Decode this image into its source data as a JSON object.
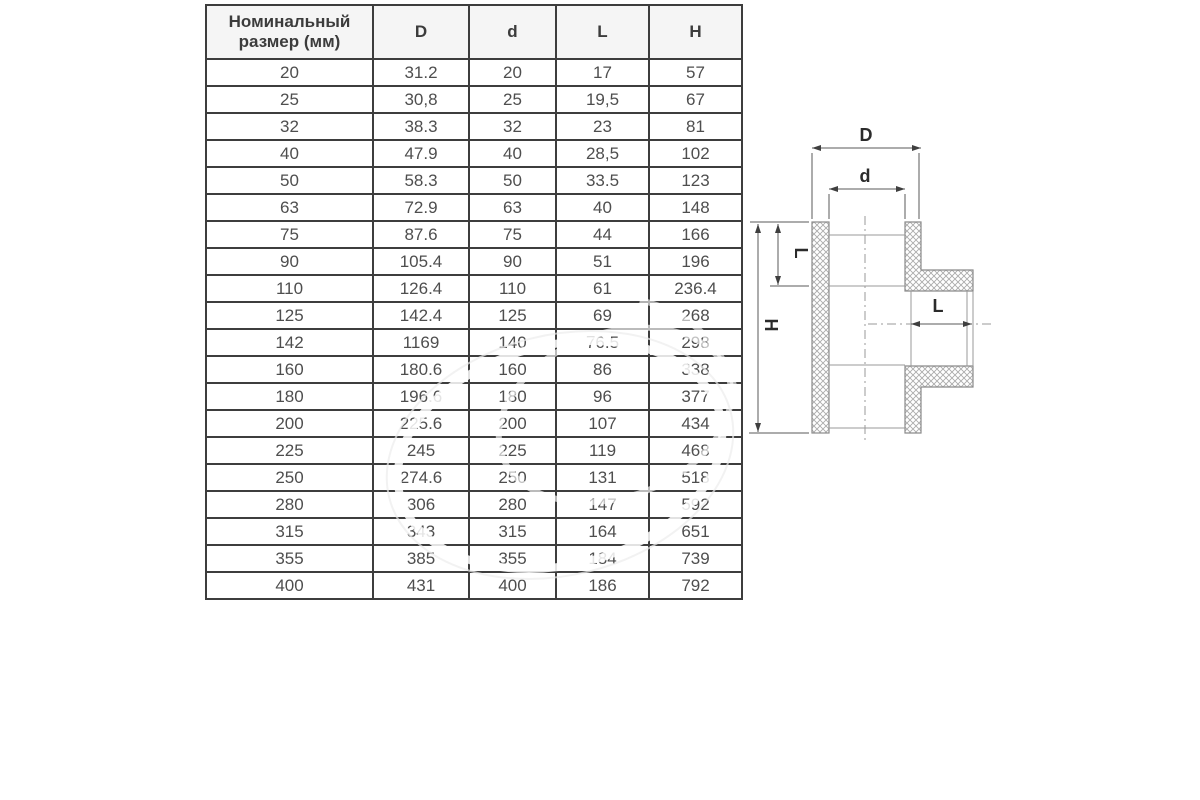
{
  "table": {
    "headers": [
      "Номинальный размер (мм)",
      "D",
      "d",
      "L",
      "H"
    ],
    "rows": [
      [
        "20",
        "31.2",
        "20",
        "17",
        "57"
      ],
      [
        "25",
        "30,8",
        "25",
        "19,5",
        "67"
      ],
      [
        "32",
        "38.3",
        "32",
        "23",
        "81"
      ],
      [
        "40",
        "47.9",
        "40",
        "28,5",
        "102"
      ],
      [
        "50",
        "58.3",
        "50",
        "33.5",
        "123"
      ],
      [
        "63",
        "72.9",
        "63",
        "40",
        "148"
      ],
      [
        "75",
        "87.6",
        "75",
        "44",
        "166"
      ],
      [
        "90",
        "105.4",
        "90",
        "51",
        "196"
      ],
      [
        "110",
        "126.4",
        "110",
        "61",
        "236.4"
      ],
      [
        "125",
        "142.4",
        "125",
        "69",
        "268"
      ],
      [
        "142",
        "1169",
        "140",
        "76.5",
        "298"
      ],
      [
        "160",
        "180.6",
        "160",
        "86",
        "338"
      ],
      [
        "180",
        "196.6",
        "180",
        "96",
        "377"
      ],
      [
        "200",
        "225.6",
        "200",
        "107",
        "434"
      ],
      [
        "225",
        "245",
        "225",
        "119",
        "468"
      ],
      [
        "250",
        "274.6",
        "250",
        "131",
        "518"
      ],
      [
        "280",
        "306",
        "280",
        "147",
        "592"
      ],
      [
        "315",
        "343",
        "315",
        "164",
        "651"
      ],
      [
        "355",
        "385",
        "355",
        "184",
        "739"
      ],
      [
        "400",
        "431",
        "400",
        "186",
        "792"
      ]
    ]
  },
  "diagram": {
    "labels": {
      "outer_diameter": "D",
      "socket_diameter": "d",
      "socket_depth_left": "L",
      "total_height": "H",
      "branch_socket_depth": "L"
    }
  },
  "colors": {
    "table_border": "#3d3d3d",
    "table_text": "#4e4e4e",
    "header_background": "#f5f5f5",
    "drawing_line": "#8a8a8a",
    "dimension_line": "#5a5a5a",
    "label_text": "#2b2b2b",
    "background": "#ffffff"
  }
}
